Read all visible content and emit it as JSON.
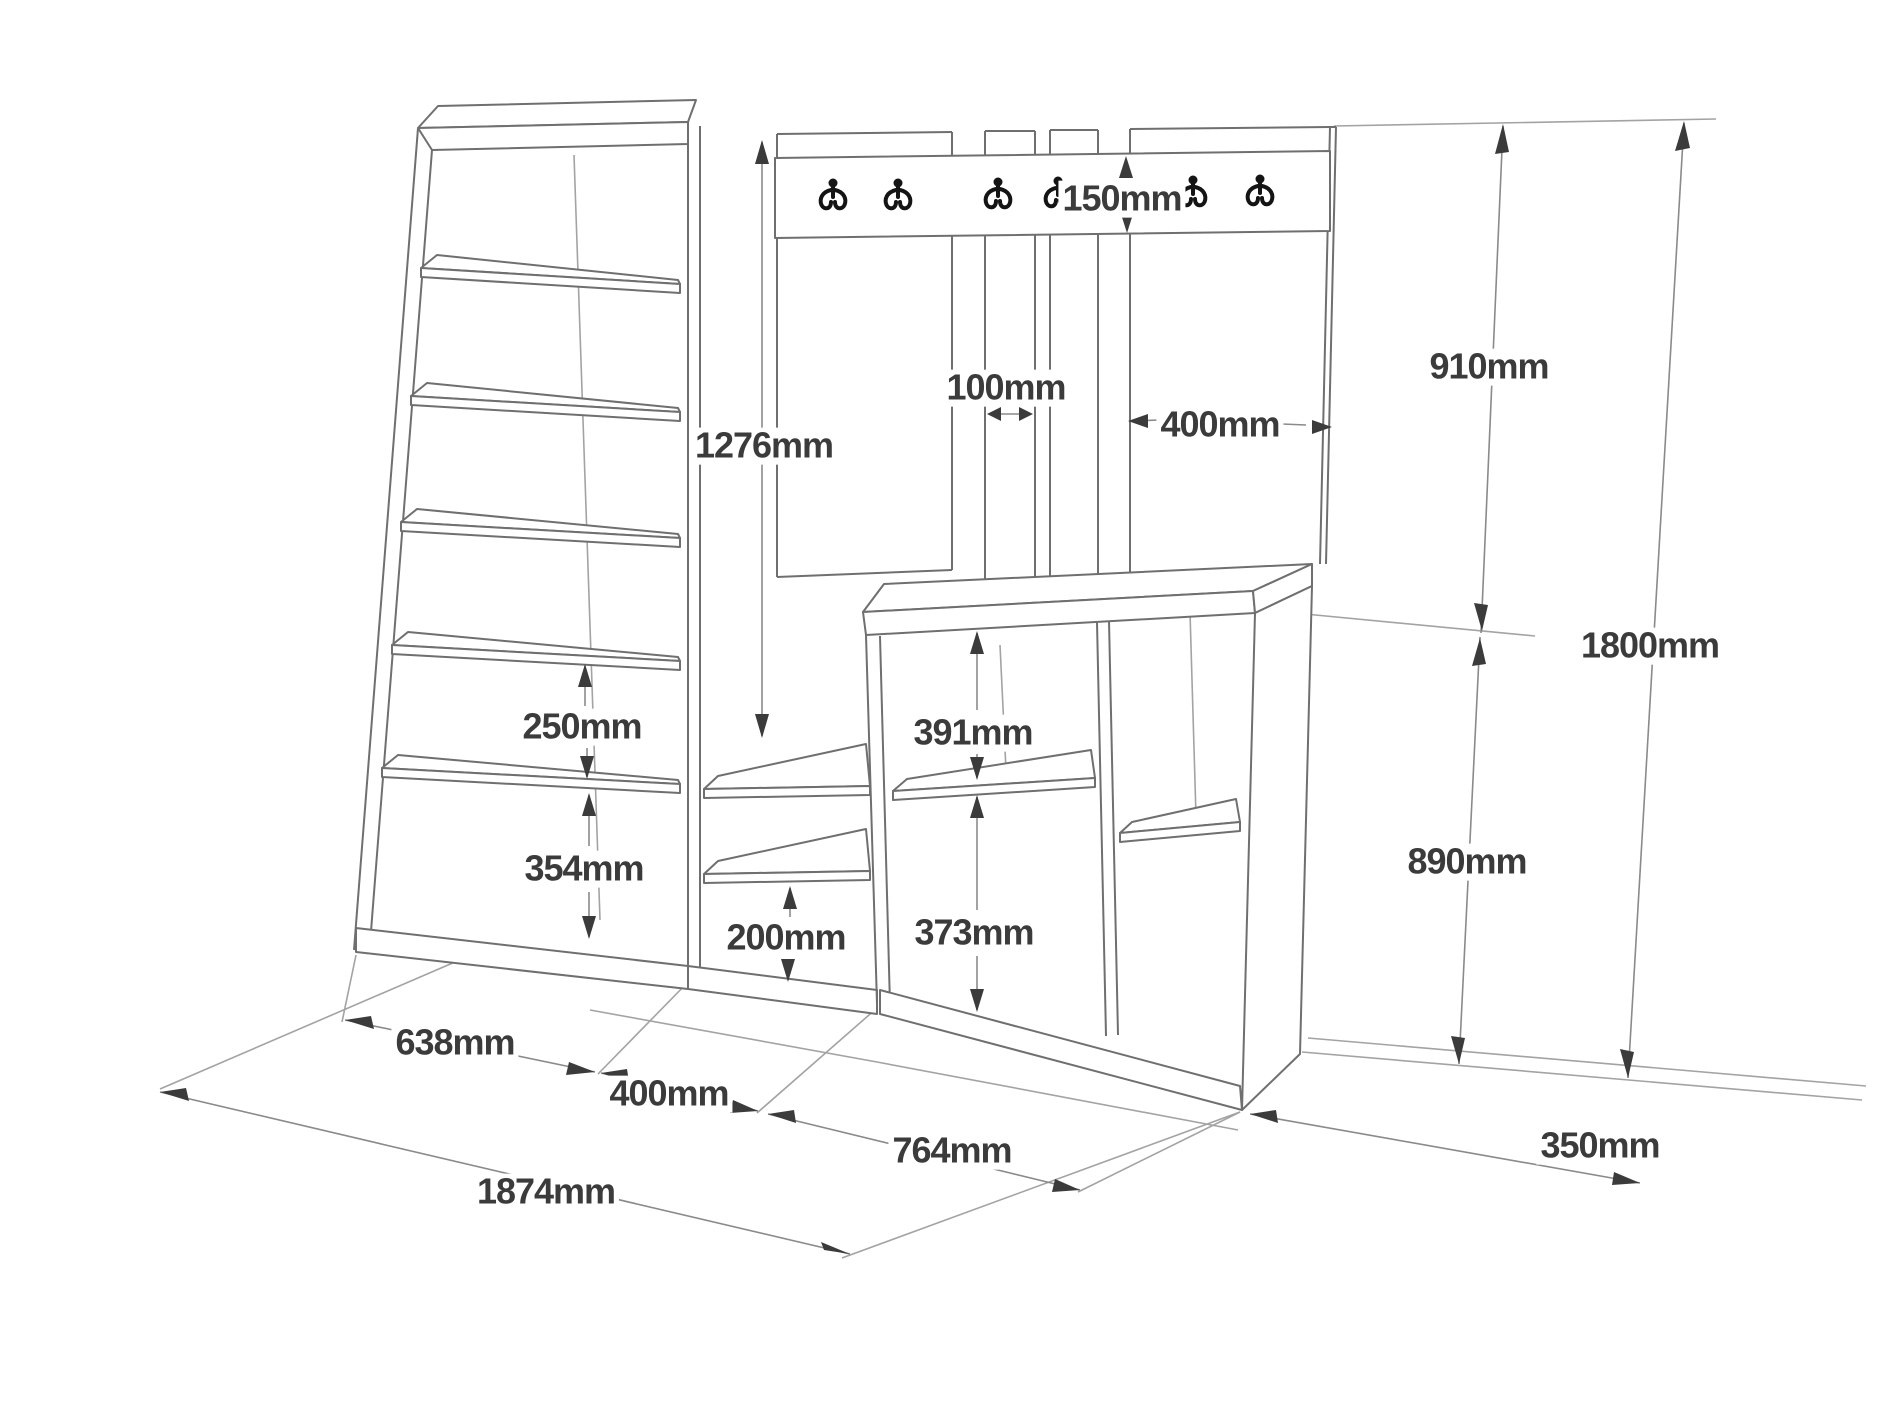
{
  "figure": {
    "type": "furniture-technical-drawing",
    "subject": "hallway coat rack unit with shelving cabinet, hook rail and shoe bench",
    "background_color": "#ffffff",
    "line_color": "#6f6f6f",
    "dimension_color": "#3b3b3b",
    "hook_color": "#141414",
    "unit_suffix": "mm"
  },
  "hooks": {
    "count": 6,
    "style": "double-prong coat hook"
  },
  "dims": {
    "rail_height": {
      "text": "150mm",
      "meaning": "hook rail board height"
    },
    "slat_width": {
      "text": "100mm",
      "meaning": "back slat width"
    },
    "back_panel_width": {
      "text": "400mm",
      "meaning": "right back panel width"
    },
    "upper_section_height": {
      "text": "910mm",
      "meaning": "upper wall section height"
    },
    "wardrobe_height": {
      "text": "1276mm",
      "meaning": "open hanging space height"
    },
    "total_height": {
      "text": "1800mm",
      "meaning": "overall height"
    },
    "shelf_gap_250": {
      "text": "250mm",
      "meaning": "cabinet shelf spacing"
    },
    "shelf_gap_354": {
      "text": "354mm",
      "meaning": "cabinet bottom compartment height"
    },
    "bench_top_cubby": {
      "text": "391mm",
      "meaning": "bench upper cubby height"
    },
    "mid_shelf_gap": {
      "text": "200mm",
      "meaning": "low shelf compartment height"
    },
    "bench_bottom_cubby": {
      "text": "373mm",
      "meaning": "bench lower cubby height"
    },
    "lower_section_height": {
      "text": "890mm",
      "meaning": "bench section height"
    },
    "cabinet_width": {
      "text": "638mm",
      "meaning": "left cabinet width"
    },
    "wardrobe_width": {
      "text": "400mm",
      "meaning": "middle section width"
    },
    "bench_width": {
      "text": "764mm",
      "meaning": "bench width"
    },
    "total_width": {
      "text": "1874mm",
      "meaning": "overall width"
    },
    "depth": {
      "text": "350mm",
      "meaning": "unit depth"
    }
  }
}
